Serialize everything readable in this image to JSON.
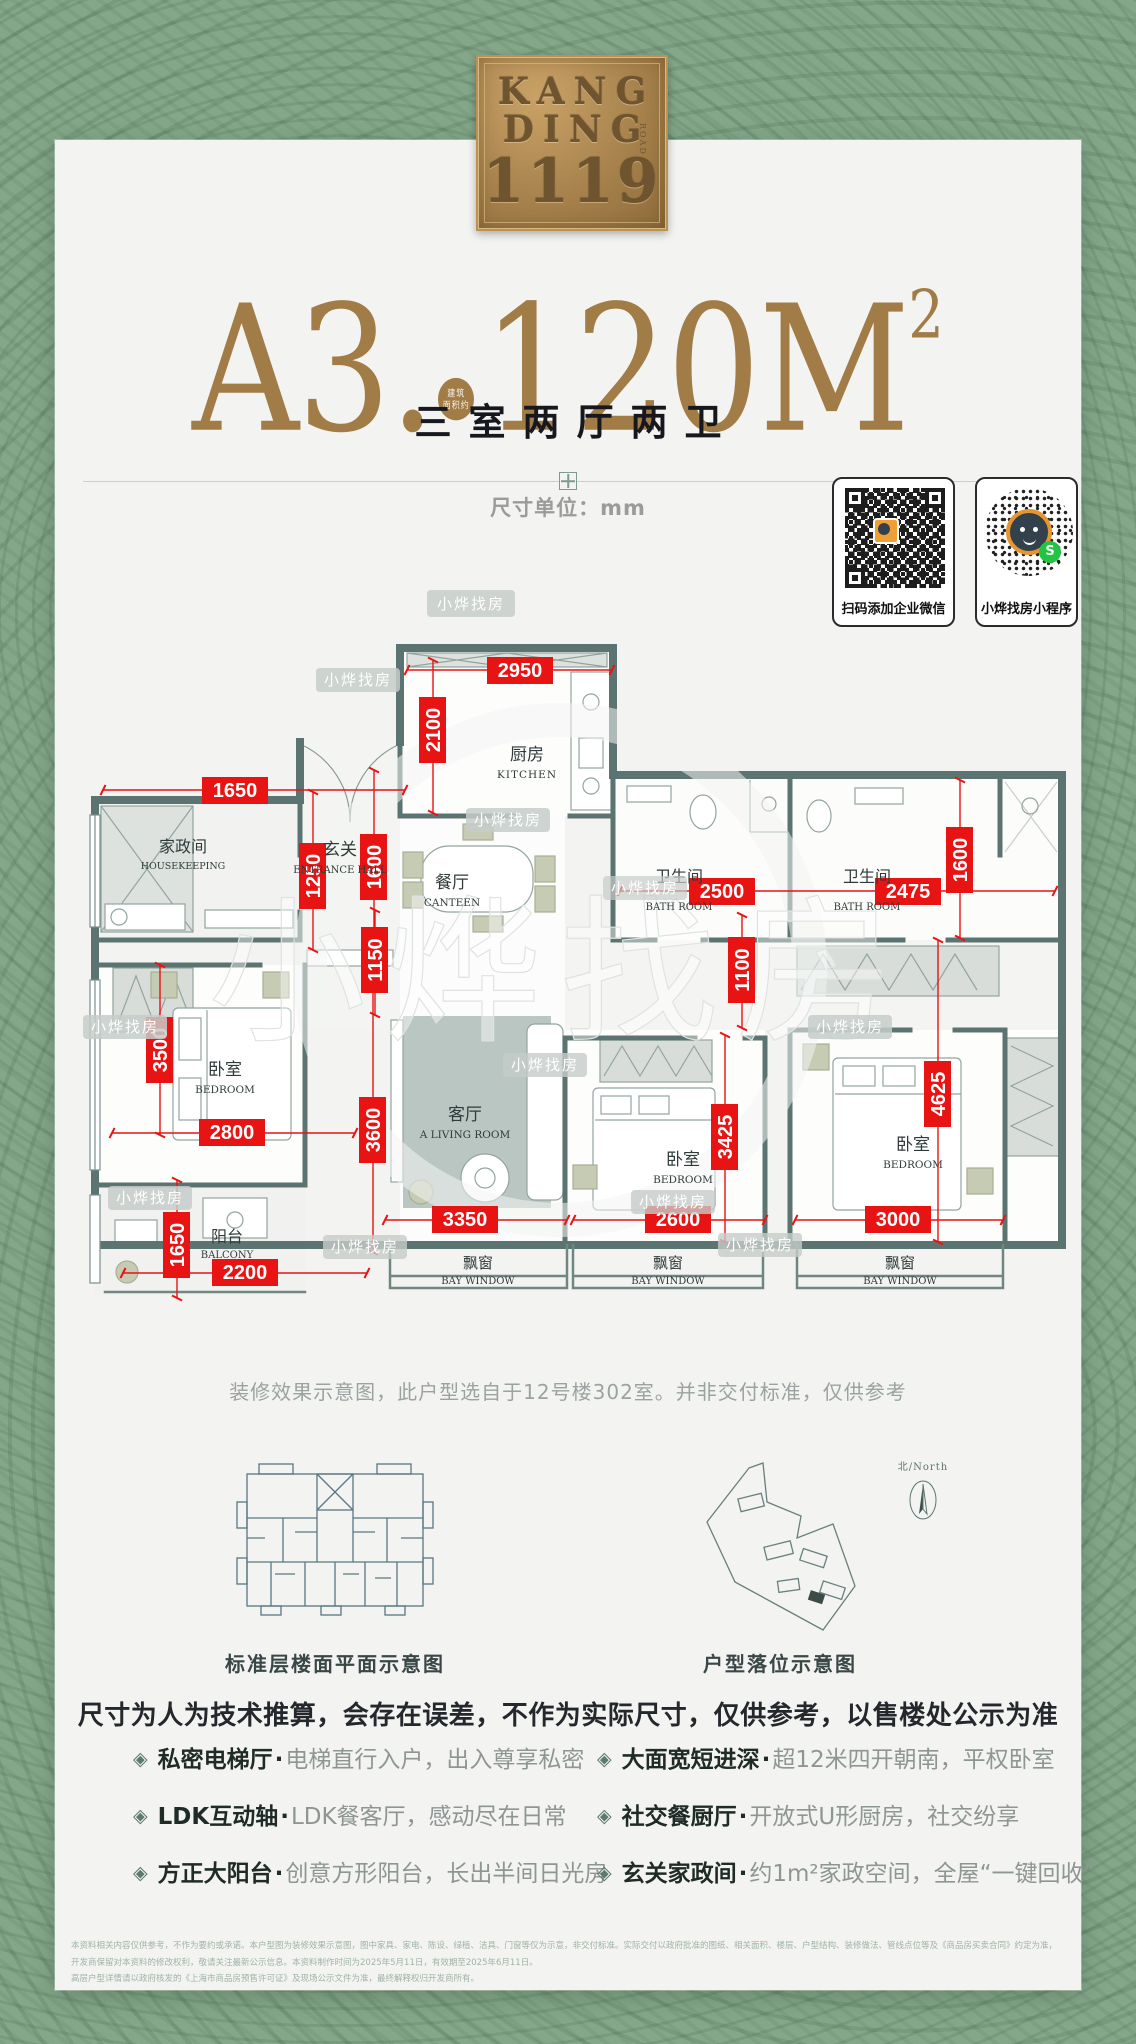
{
  "logo": {
    "line1": "KANG",
    "line2": "DING",
    "line3": "1119",
    "side": "ROAD"
  },
  "title": {
    "model": "A3.",
    "area": "120M",
    "sup": "2",
    "badge_line1": "建筑",
    "badge_line2": "面积约"
  },
  "subtitle": "三室两厅两卫",
  "unit_label": "尺寸单位：mm",
  "qr": [
    {
      "caption": "扫码添加企业微信"
    },
    {
      "caption": "小烨找房小程序"
    }
  ],
  "qr_mini_glyph": "S",
  "watermark": "小烨找房",
  "plan": {
    "rooms": {
      "kitchen": {
        "zh": "厨房",
        "en": "KITCHEN"
      },
      "housekeeping": {
        "zh": "家政间",
        "en": "HOUSEKEEPING"
      },
      "entrance": {
        "zh": "玄关",
        "en": "ENTRANCE HALL"
      },
      "canteen": {
        "zh": "餐厅",
        "en": "CANTEEN"
      },
      "bath": {
        "zh": "卫生间",
        "en": "BATH ROOM"
      },
      "bedroom": {
        "zh": "卧室",
        "en": "BEDROOM"
      },
      "living": {
        "zh": "客厅",
        "en": "A LIVING ROOM"
      },
      "balcony": {
        "zh": "阳台",
        "en": "BALCONY"
      },
      "bay": {
        "zh": "飘窗",
        "en": "BAY WINDOW"
      }
    },
    "dims": [
      "2950",
      "2100",
      "1650",
      "1250",
      "1600",
      "2500",
      "2475",
      "1600",
      "1100",
      "1150",
      "3500",
      "2800",
      "3600",
      "3350",
      "1650",
      "2200",
      "3425",
      "2600",
      "4625",
      "3000"
    ]
  },
  "caption": "装修效果示意图，此户型选自于12号楼302室。并非交付标准，仅供参考",
  "diagrams": {
    "floor_label": "标准层楼面平面示意图",
    "site_label": "户型落位示意图",
    "north": "北/North"
  },
  "notice": "尺寸为人为技术推算，会存在误差，不作为实际尺寸，仅供参考，以售楼处公示为准",
  "features": [
    {
      "title": "私密电梯厅",
      "sep": "·",
      "desc": "电梯直行入户，出入尊享私密"
    },
    {
      "title": "大面宽短进深",
      "sep": "·",
      "desc": "超12米四开朝南，平权卧室"
    },
    {
      "title": "LDK互动轴",
      "sep": "·",
      "desc": "LDK餐客厅，感动尽在日常"
    },
    {
      "title": "社交餐厨厅",
      "sep": "·",
      "desc": "开放式U形厨房，社交纷享"
    },
    {
      "title": "方正大阳台",
      "sep": "·",
      "desc": "创意方形阳台，长出半间日光房"
    },
    {
      "title": "玄关家政间",
      "sep": "·",
      "desc": "约1m²家政空间，全屋“一键回收”"
    }
  ],
  "disclaimer": {
    "line1": "本资料相关内容仅供参考，不作为要约或承诺。本户型图为装修效果示意图，图中家具、家电、陈设、绿植、洁具、门窗等仅为示意，非交付标准。实际交付以政府批准的图纸、相关面积、楼层、户型结构、装修做法、管线点位等及《商品房买卖合同》约定为准，开发商保留对本资料的修改权利，敬请关注最新公示信息。本资料制作时间为2025年5月11日，有效期至2025年6月11日。",
    "line2": "高层户型详情请以政府核发的《上海市商品房预售许可证》及现场公示文件为准，最终解释权归开发商所有。"
  }
}
